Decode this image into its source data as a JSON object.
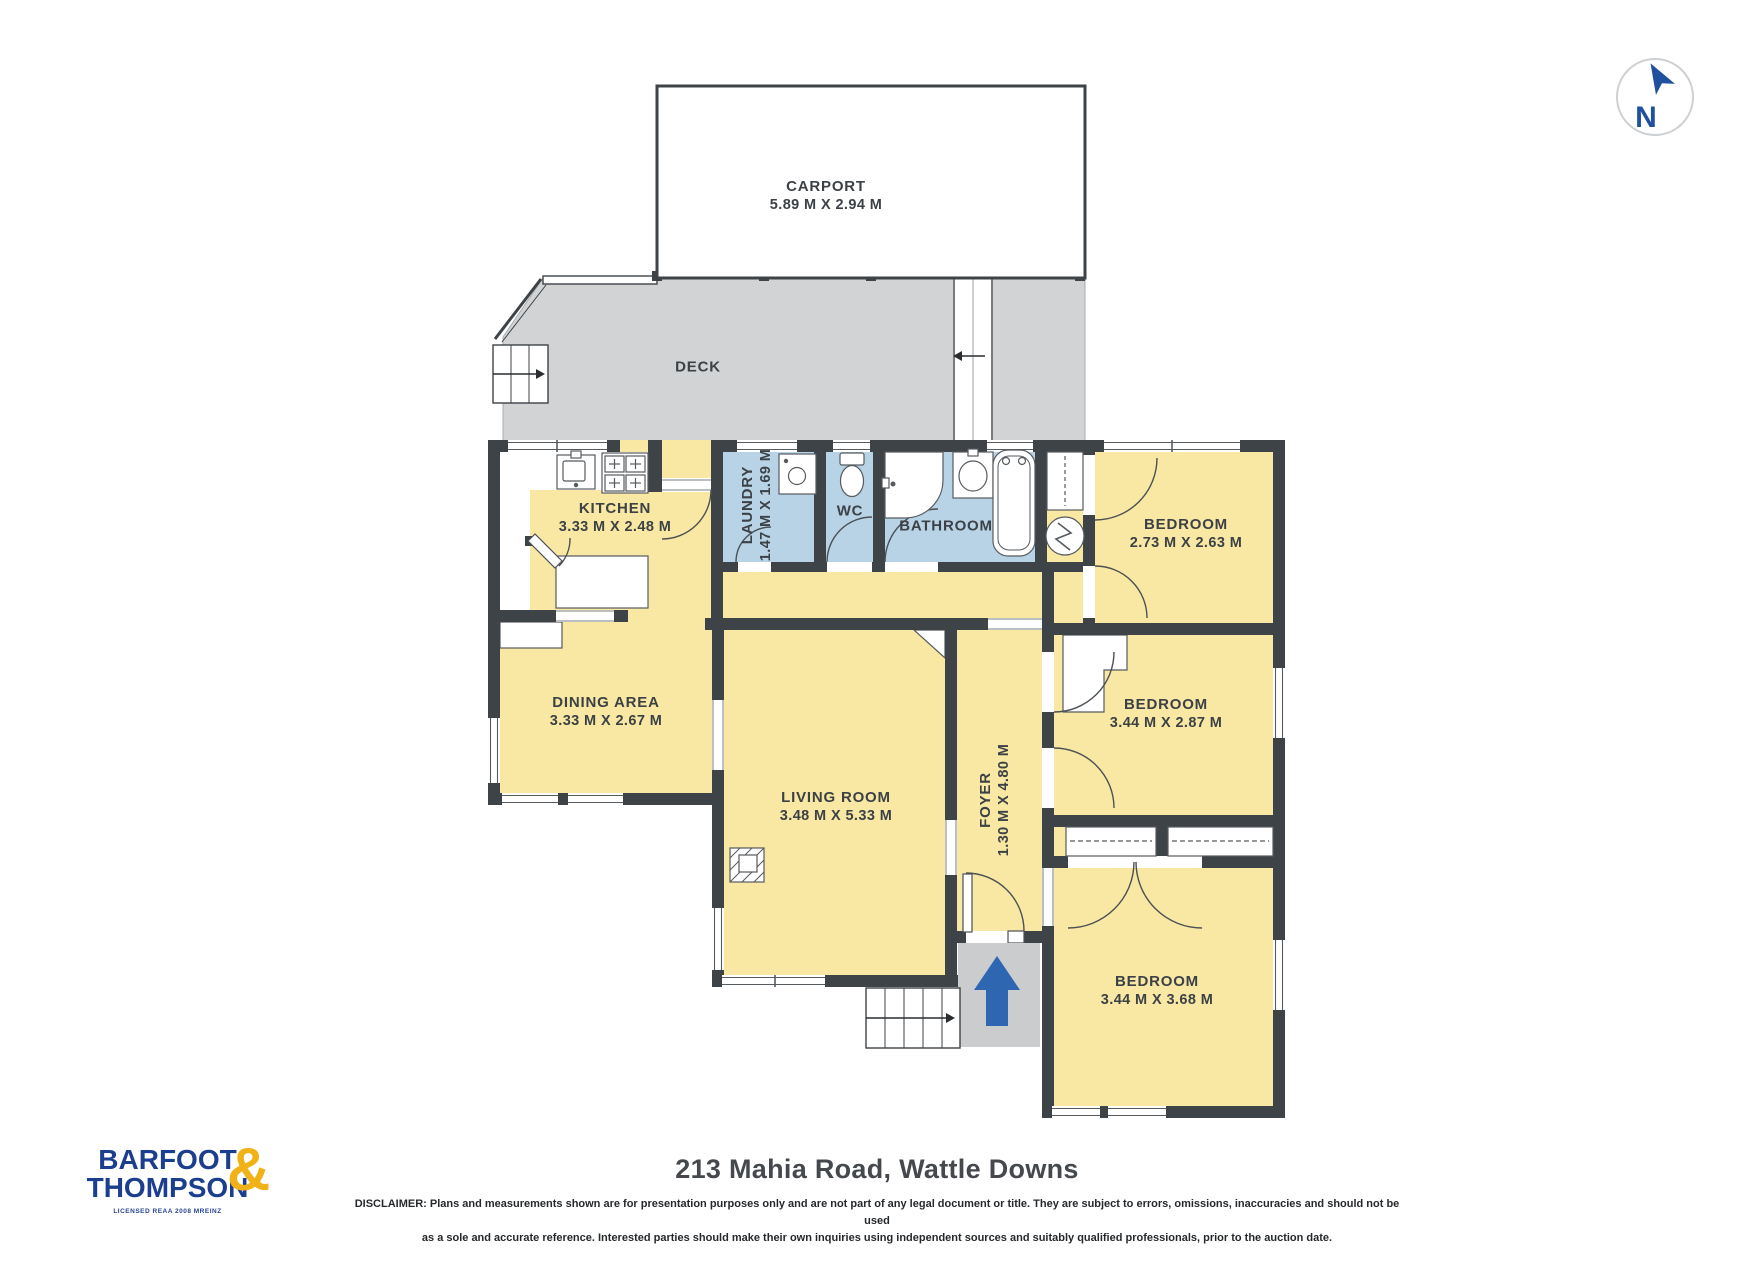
{
  "rooms": {
    "carport": {
      "name": "CARPORT",
      "dims": "5.89 M X 2.94 M"
    },
    "deck": {
      "name": "DECK",
      "dims": ""
    },
    "kitchen": {
      "name": "KITCHEN",
      "dims": "3.33 M X 2.48 M"
    },
    "dining": {
      "name": "DINING AREA",
      "dims": "3.33 M X 2.67 M"
    },
    "laundry": {
      "name": "LAUNDRY",
      "dims": "1.47 M X 1.69 M"
    },
    "wc": {
      "name": "WC",
      "dims": ""
    },
    "bathroom": {
      "name": "BATHROOM",
      "dims": ""
    },
    "bedroom1": {
      "name": "BEDROOM",
      "dims": "2.73 M X 2.63 M"
    },
    "bedroom2": {
      "name": "BEDROOM",
      "dims": "3.44 M X 2.87 M"
    },
    "bedroom3": {
      "name": "BEDROOM",
      "dims": "3.44 M X 3.68 M"
    },
    "living": {
      "name": "LIVING ROOM",
      "dims": "3.48 M X 5.33 M"
    },
    "foyer": {
      "name": "FOYER",
      "dims": "1.30 M X 4.80 M"
    }
  },
  "compass": {
    "label": "N"
  },
  "branding": {
    "line1": "BARFOOT",
    "line2": "THOMPSON",
    "ampersand": "&",
    "sub": "LICENSED REAA 2008 MREINZ"
  },
  "footer": {
    "title": "213 Mahia Road, Wattle Downs",
    "disclaimer_line1": "DISCLAIMER: Plans and measurements shown are for presentation purposes only and are not part of any legal document or title. They are subject to errors, omissions, inaccuracies and should not be used",
    "disclaimer_line2": "as a sole and accurate reference. Interested parties should make their own inquiries using independent sources and suitably qualified professionals, prior to the auction date."
  },
  "colors": {
    "wall": "#3e4347",
    "room_yellow": "#f8e8a3",
    "wet_room_blue": "#b9d3e6",
    "deck_gray": "#d1d3d5",
    "porch_gray": "#caccce",
    "entry_arrow_blue": "#2e66b2",
    "brand_navy": "#1c3e8f",
    "brand_yellow": "#f0b216"
  }
}
